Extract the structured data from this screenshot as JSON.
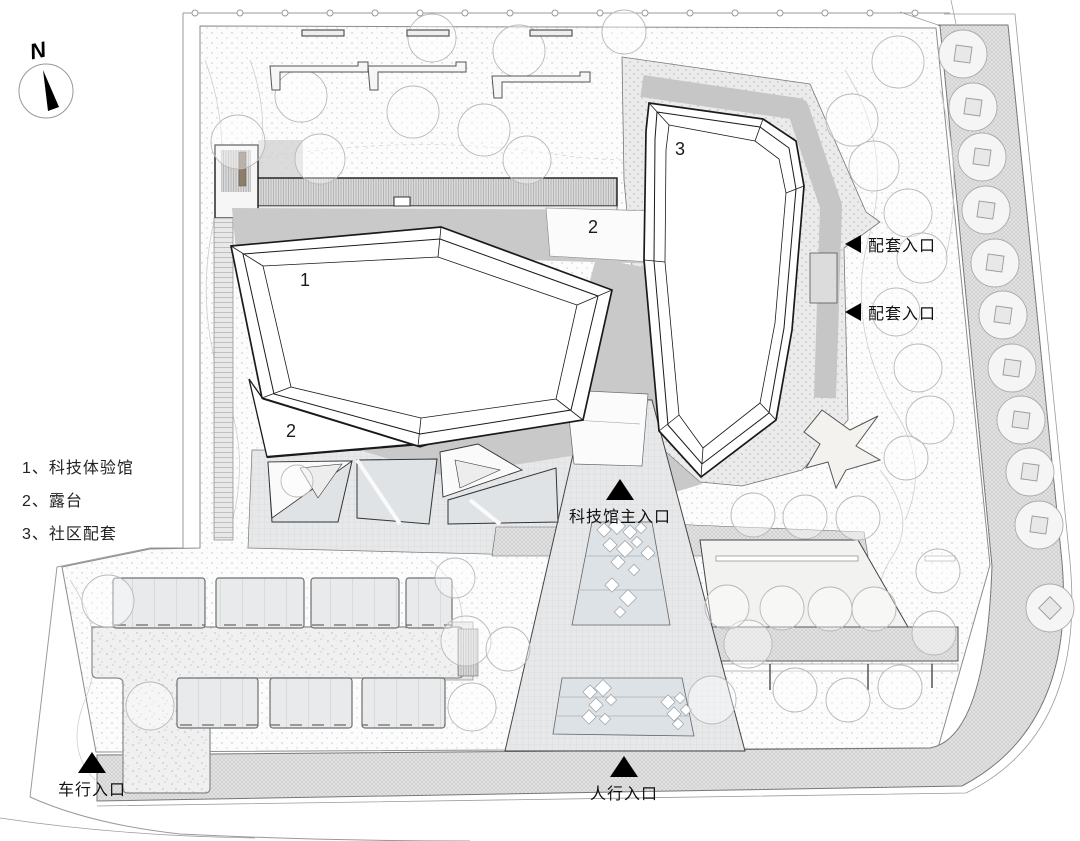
{
  "meta": {
    "drawing_type": "architectural site plan",
    "palette": {
      "paper": "#ffffff",
      "shadow_gray": "#c9c9c9",
      "paving_gray": "#e7e8ea",
      "planter_blue_gray": "#dfe3e6",
      "line_dark": "#1a1a1a",
      "annotation_black": "#000000"
    }
  },
  "north_arrow": {
    "label": "N"
  },
  "legend": {
    "items": [
      {
        "num": "1、",
        "label": "科技体验馆"
      },
      {
        "num": "2、",
        "label": "露台"
      },
      {
        "num": "3、",
        "label": "社区配套"
      }
    ]
  },
  "building_labels": {
    "hall": "1",
    "terrace_upper": "2",
    "terrace_lower": "2",
    "community": "3"
  },
  "entrances": {
    "service_1": "配套入口",
    "service_2": "配套入口",
    "main": "科技馆主入口",
    "vehicle": "车行入口",
    "pedestrian": "人行入口"
  }
}
